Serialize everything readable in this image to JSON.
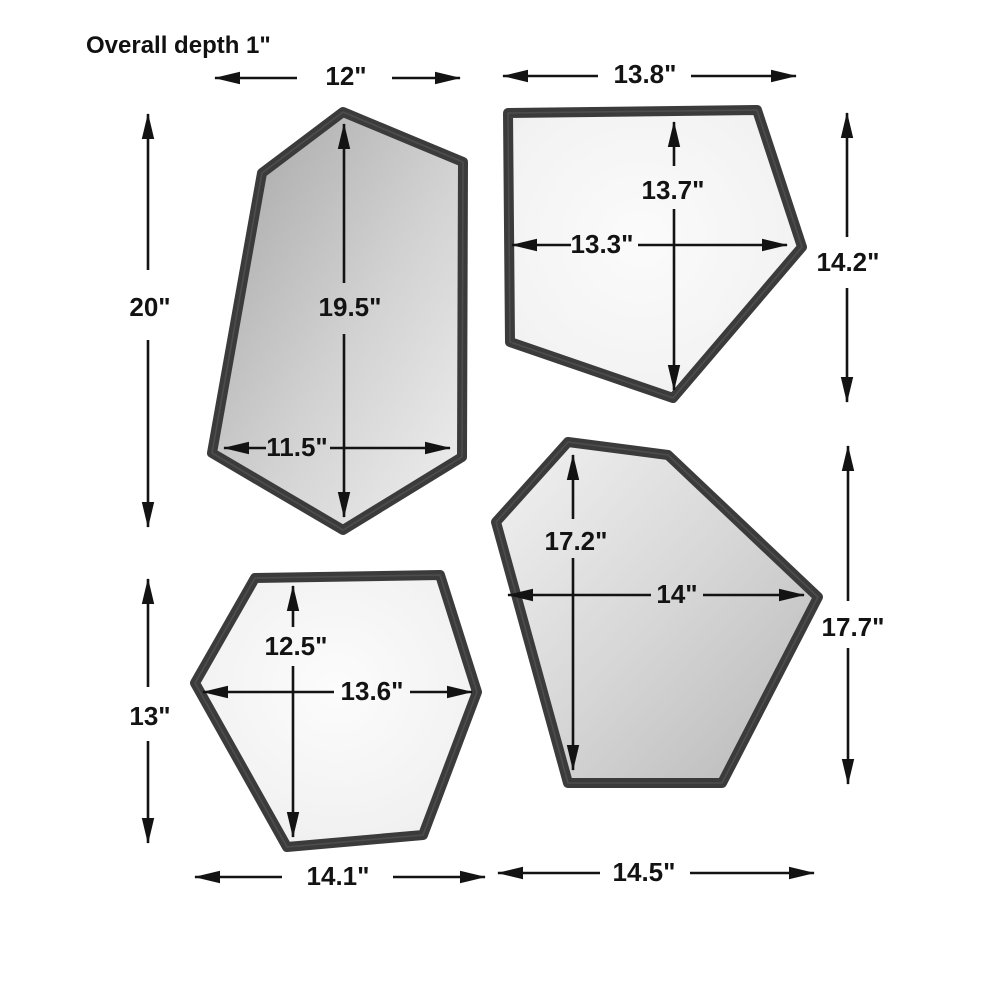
{
  "diagram": {
    "note": "Overall depth 1\"",
    "mirrors": [
      {
        "name": "top-left-mirror",
        "overall_width": "12\"",
        "overall_height": "20\"",
        "inner_height": "19.5\"",
        "inner_width": "11.5\""
      },
      {
        "name": "top-right-mirror",
        "overall_width": "13.8\"",
        "overall_height": "14.2\"",
        "inner_height": "13.7\"",
        "inner_width": "13.3\""
      },
      {
        "name": "bottom-left-mirror",
        "overall_width": "14.1\"",
        "overall_height": "13\"",
        "inner_height": "12.5\"",
        "inner_width": "13.6\""
      },
      {
        "name": "bottom-right-mirror",
        "overall_width": "14.5\"",
        "overall_height": "17.7\"",
        "inner_height": "17.2\"",
        "inner_width": "14\""
      }
    ],
    "colors": {
      "frame": "#3b3b3b",
      "dimension_line": "#131313",
      "background": "#ffffff"
    }
  }
}
